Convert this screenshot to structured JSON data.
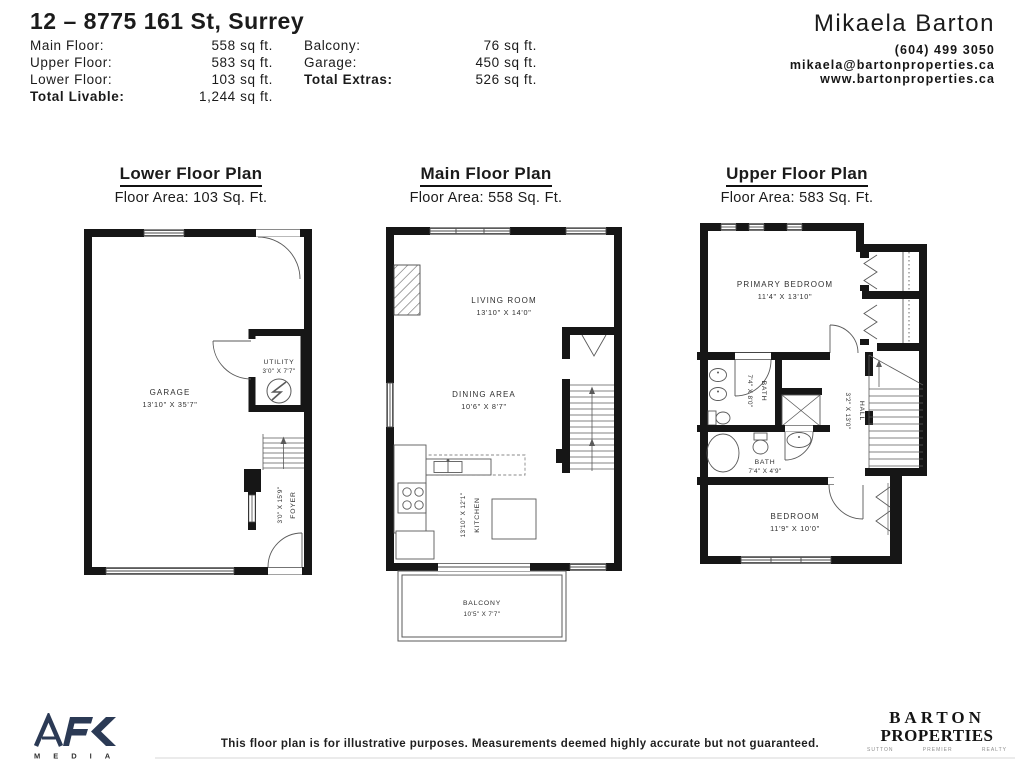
{
  "header": {
    "address": "12 – 8775 161 St, Surrey",
    "stats_left": [
      {
        "label": "Main Floor:",
        "value": "558 sq ft."
      },
      {
        "label": "Upper Floor:",
        "value": "583 sq ft."
      },
      {
        "label": "Lower Floor:",
        "value": "103 sq ft."
      },
      {
        "label": "Total Livable:",
        "value": "1,244 sq ft."
      }
    ],
    "stats_right": [
      {
        "label": "Balcony:",
        "value": "76 sq ft."
      },
      {
        "label": "Garage:",
        "value": "450 sq ft."
      },
      {
        "label": "Total Extras:",
        "value": "526 sq ft."
      }
    ],
    "agent": {
      "name": "Mikaela Barton",
      "phone": "(604) 499 3050",
      "email": "mikaela@bartonproperties.ca",
      "website": "www.bartonproperties.ca"
    }
  },
  "plans": {
    "lower": {
      "title": "Lower Floor Plan",
      "subtitle": "Floor Area: 103 Sq. Ft.",
      "rooms": {
        "garage": {
          "name": "GARAGE",
          "dims": "13'10\" X 35'7\""
        },
        "utility": {
          "name": "UTILITY",
          "dims": "3'0\" X 7'7\""
        },
        "foyer": {
          "name": "FOYER",
          "dims": "3'0\" X 15'9\""
        }
      }
    },
    "main": {
      "title": "Main Floor Plan",
      "subtitle": "Floor Area: 558 Sq. Ft.",
      "rooms": {
        "living": {
          "name": "LIVING ROOM",
          "dims": "13'10\" X 14'0\""
        },
        "dining": {
          "name": "DINING AREA",
          "dims": "10'6\" X 8'7\""
        },
        "kitchen": {
          "name": "KITCHEN",
          "dims": "13'10\" X 12'1\""
        },
        "balcony": {
          "name": "BALCONY",
          "dims": "10'5\" X 7'7\""
        }
      }
    },
    "upper": {
      "title": "Upper Floor Plan",
      "subtitle": "Floor Area: 583 Sq. Ft.",
      "rooms": {
        "primary": {
          "name": "PRIMARY BEDROOM",
          "dims": "11'4\" X 13'10\""
        },
        "bath_main": {
          "name": "BATH",
          "dims": "7'4\" X 8'0\""
        },
        "bath_second": {
          "name": "BATH",
          "dims": "7'4\" X 4'9\""
        },
        "hall": {
          "name": "HALL",
          "dims": "3'2\" X 13'0\""
        },
        "bedroom": {
          "name": "BEDROOM",
          "dims": "11'9\" X 10'0\""
        }
      }
    }
  },
  "footer": {
    "afk": {
      "brand": "AFK",
      "sub": "MEDIA",
      "color": "#2b3a55"
    },
    "disclaimer": "This floor plan is for illustrative purposes. Measurements deemed highly accurate but not guaranteed.",
    "barton": {
      "line1": "BARTON",
      "line2": "PROPERTIES",
      "sub_words": [
        "SUTTON",
        "PREMIER",
        "REALTY"
      ]
    }
  }
}
